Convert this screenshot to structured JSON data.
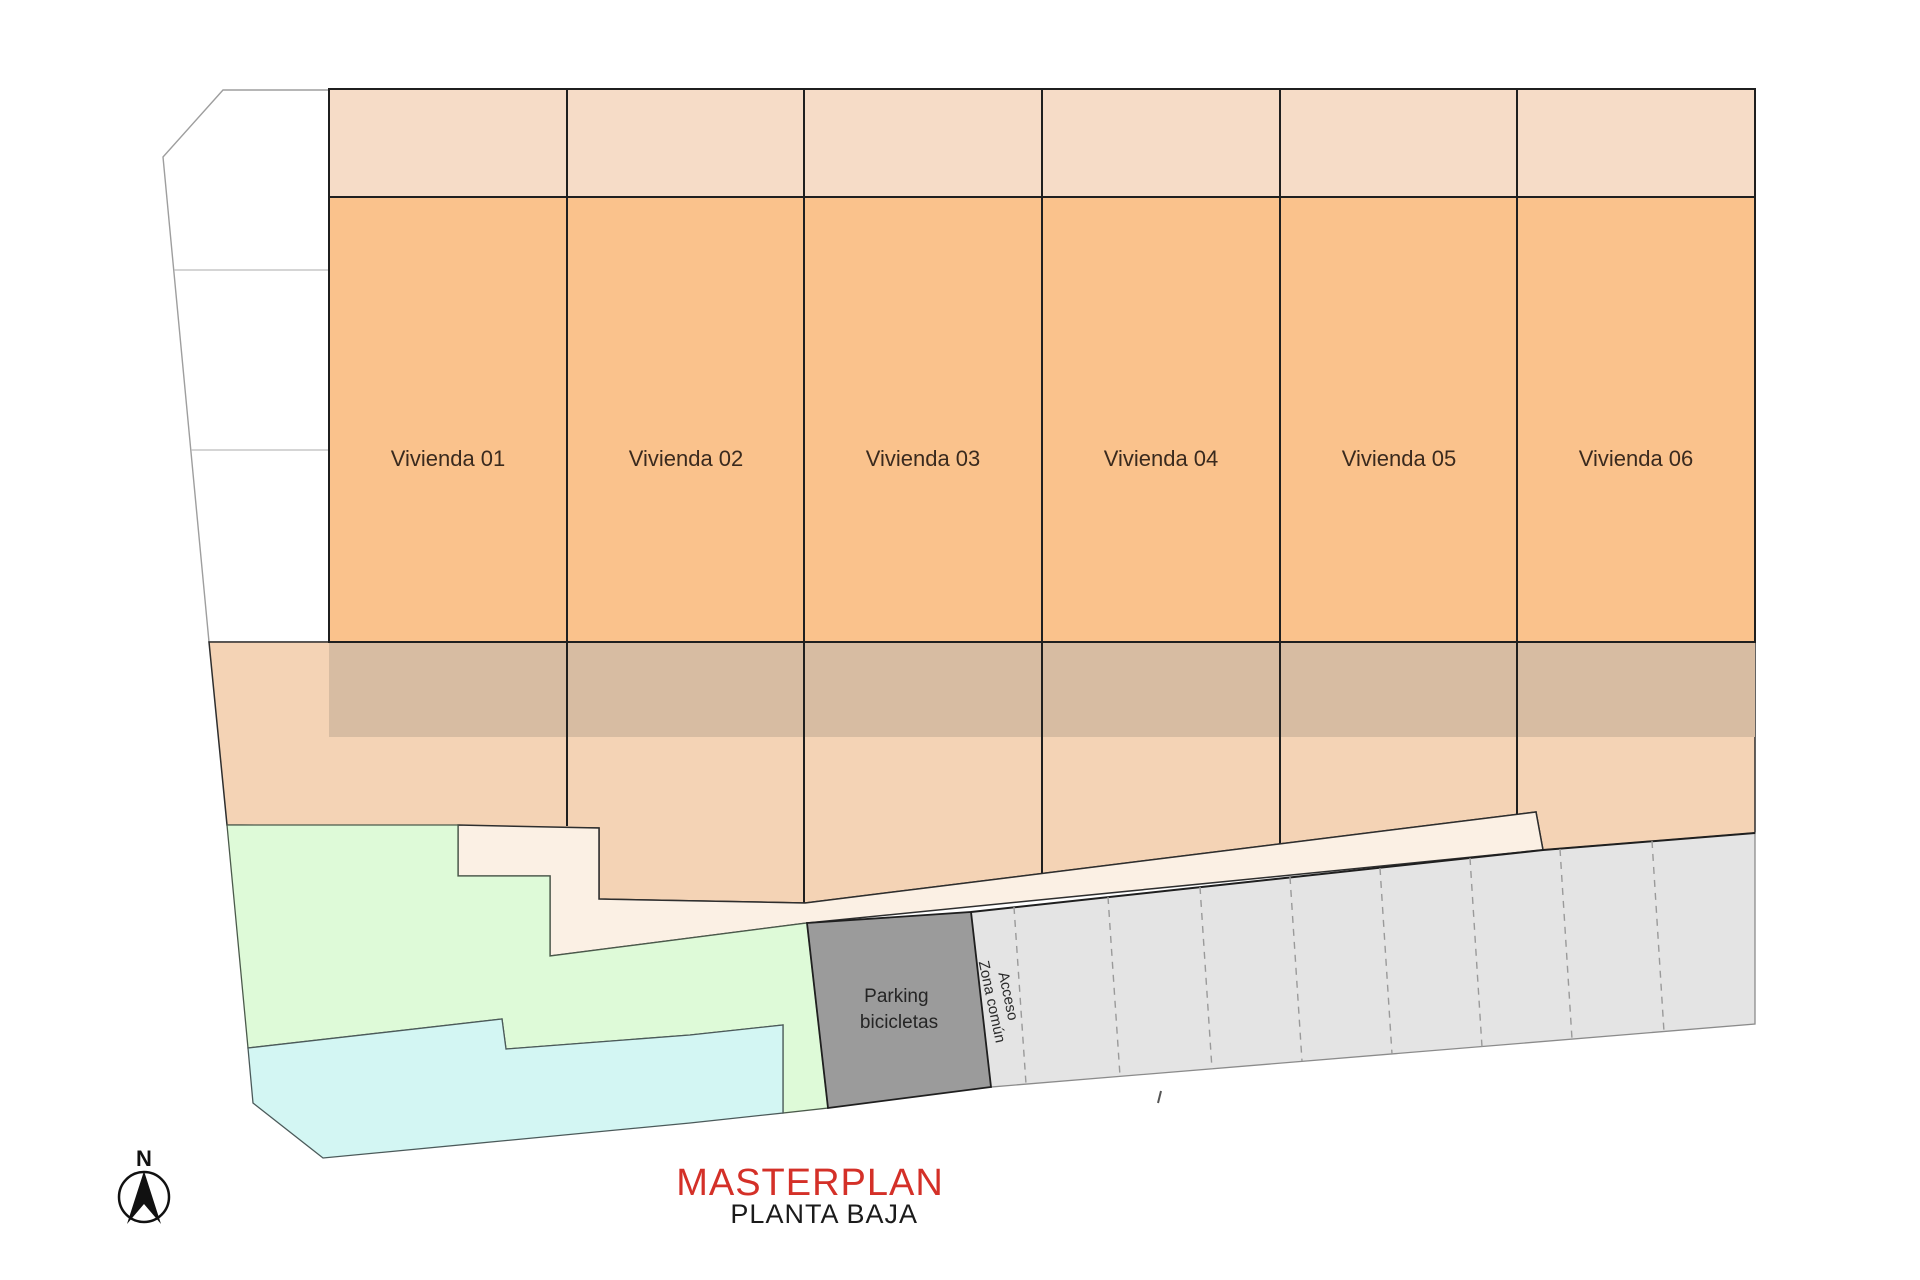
{
  "title": {
    "main": "MASTERPLAN",
    "sub": "PLANTA BAJA"
  },
  "compass": {
    "label": "N"
  },
  "viviendas": [
    {
      "label": "Vivienda 01"
    },
    {
      "label": "Vivienda 02"
    },
    {
      "label": "Vivienda 03"
    },
    {
      "label": "Vivienda 04"
    },
    {
      "label": "Vivienda 05"
    },
    {
      "label": "Vivienda 06"
    }
  ],
  "bike_parking": {
    "line1": "Parking",
    "line2": "bicicletas"
  },
  "corridor": {
    "line1": "Acceso",
    "line2": "Zona común"
  },
  "parking_strip": {
    "spaces": 8
  },
  "palette": {
    "orange": "#fac28c",
    "strip": "#f6dcc7",
    "tan": "#d7bca2",
    "peach": "#f4d3b5",
    "cream": "#fbf0e4",
    "grey_zone": "#e5e5e5",
    "grey_parking": "#e4e4e4",
    "dark_parking": "#9b9b9b",
    "green": "#defad8",
    "cyan": "#d3f6f3",
    "red_title": "#d43028",
    "white": "#ffffff"
  }
}
